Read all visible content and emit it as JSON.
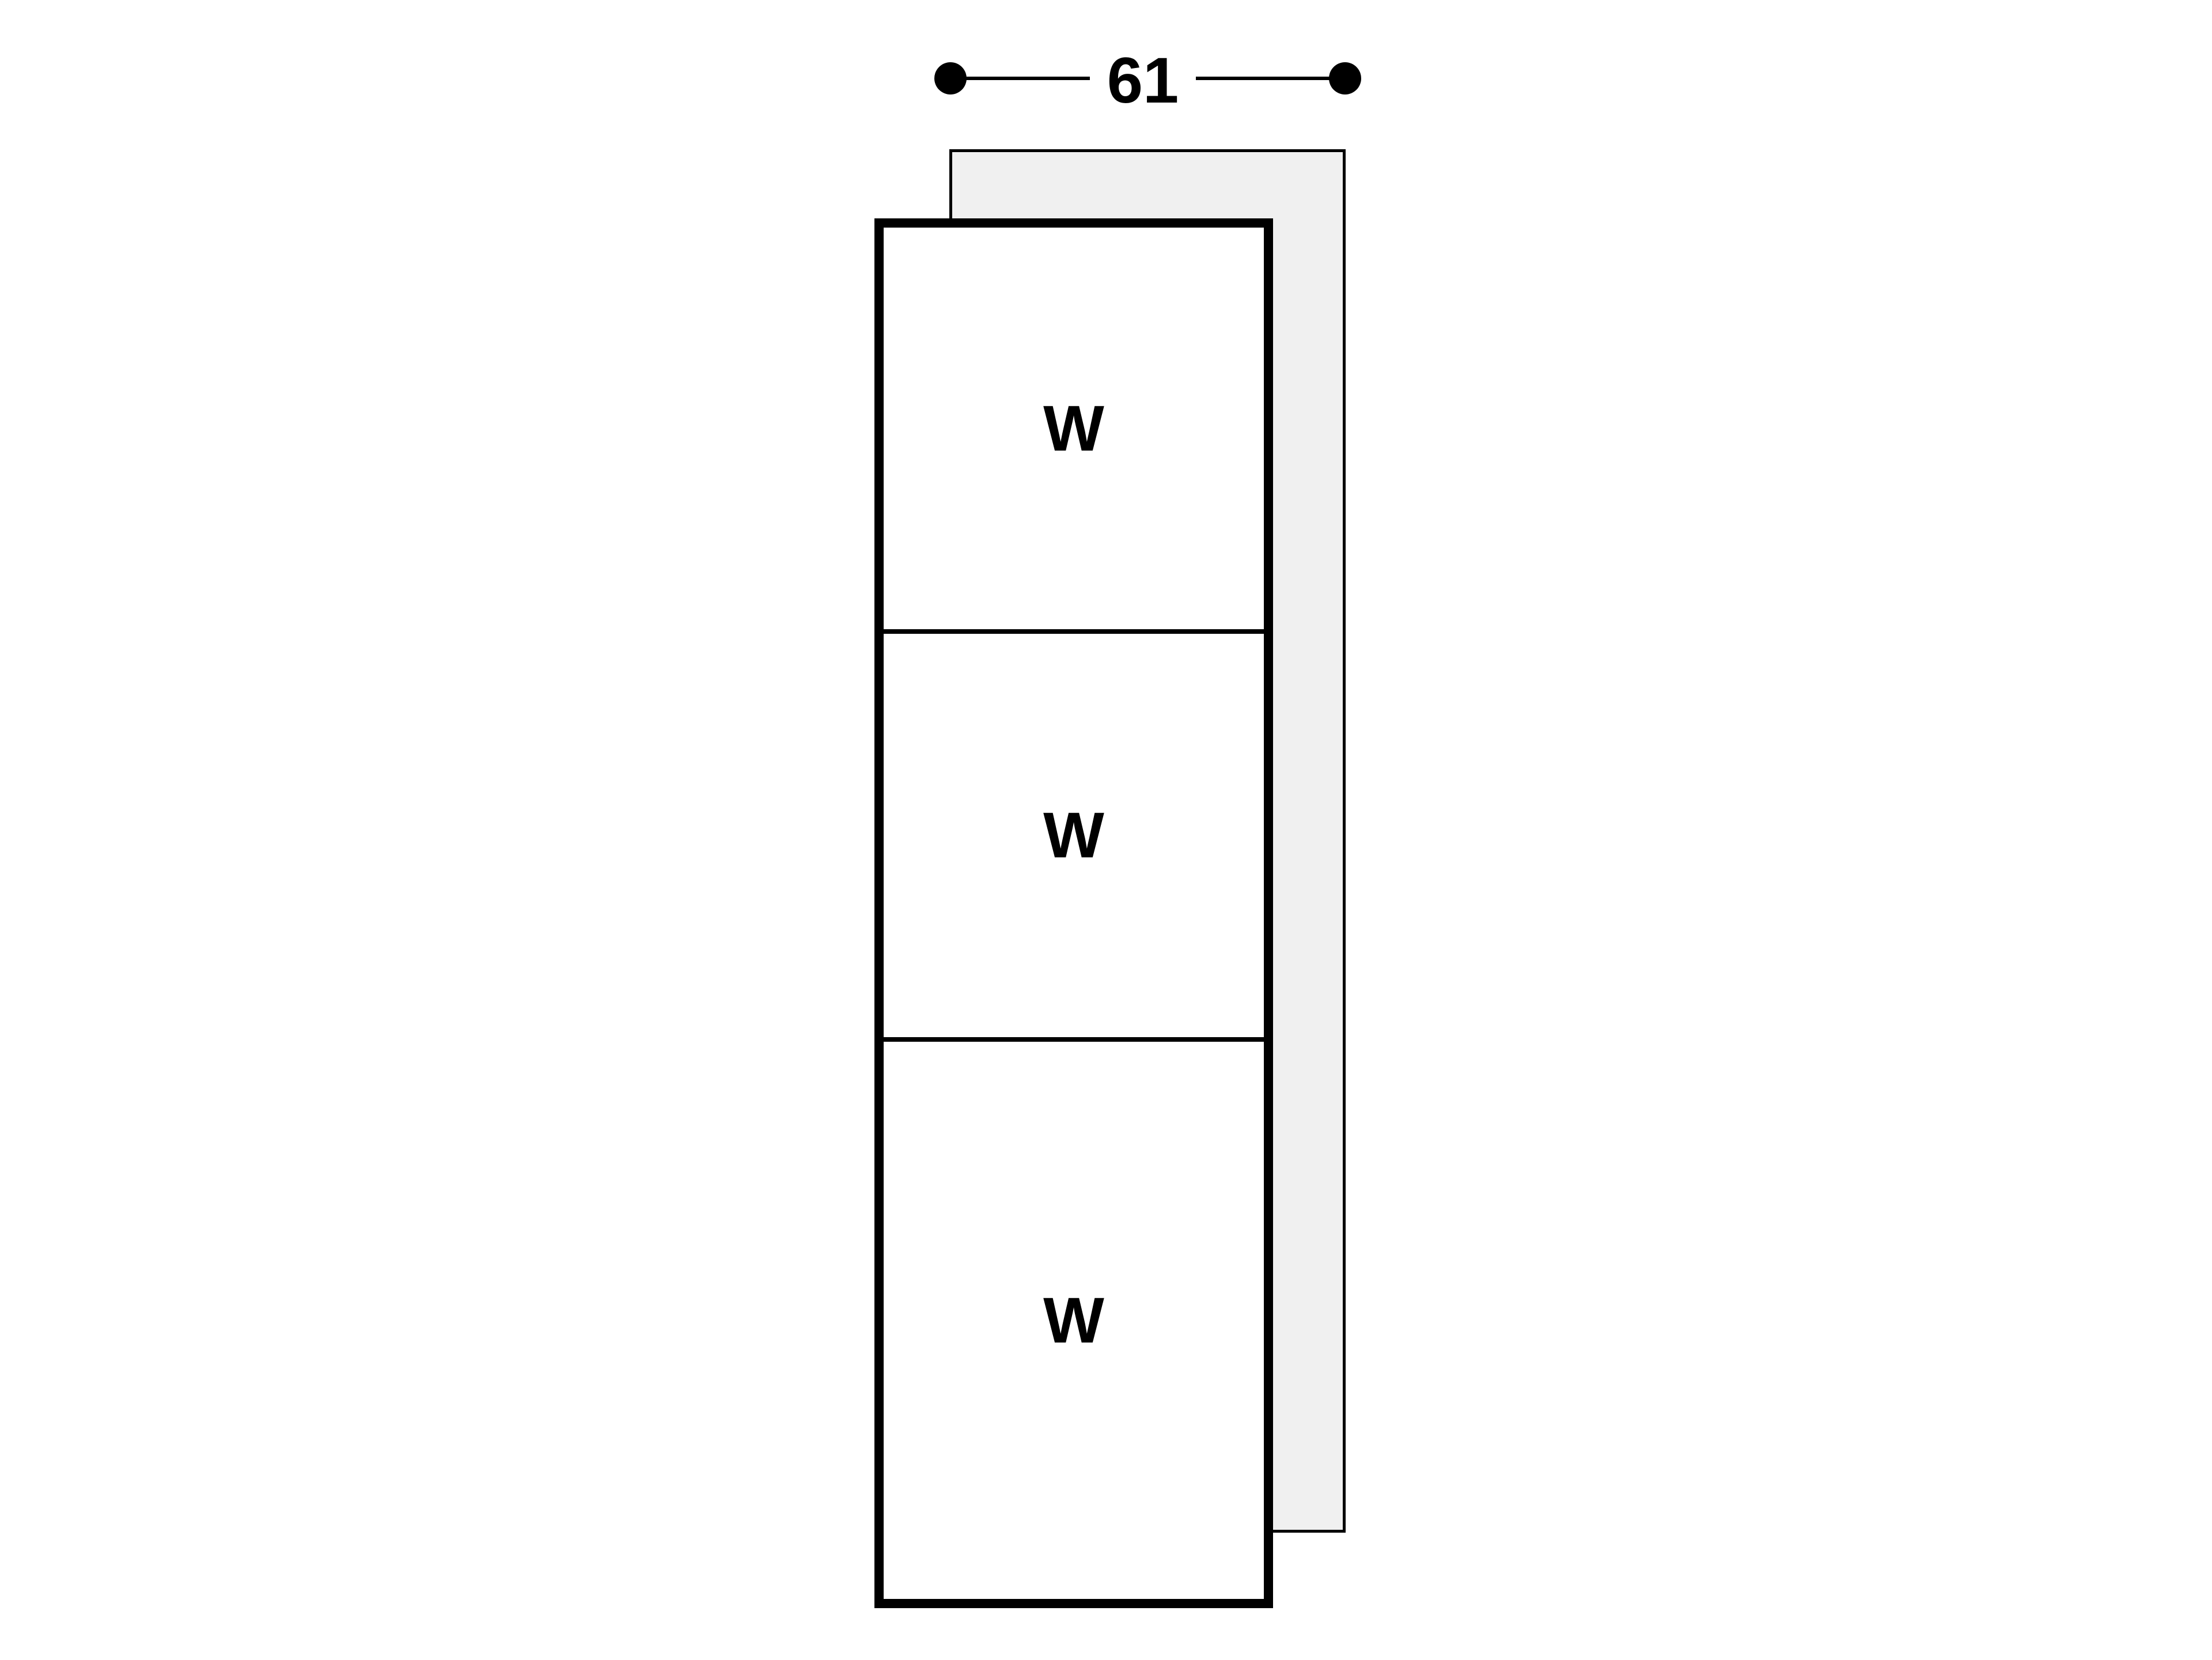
{
  "diagram": {
    "dimension_width": {
      "value": "61"
    },
    "stack": {
      "sections": [
        {
          "label": "W"
        },
        {
          "label": "W"
        },
        {
          "label": "W"
        }
      ]
    },
    "colors": {
      "line": "#000000",
      "panel_fill": "#f0f0f0",
      "background": "#ffffff"
    }
  }
}
